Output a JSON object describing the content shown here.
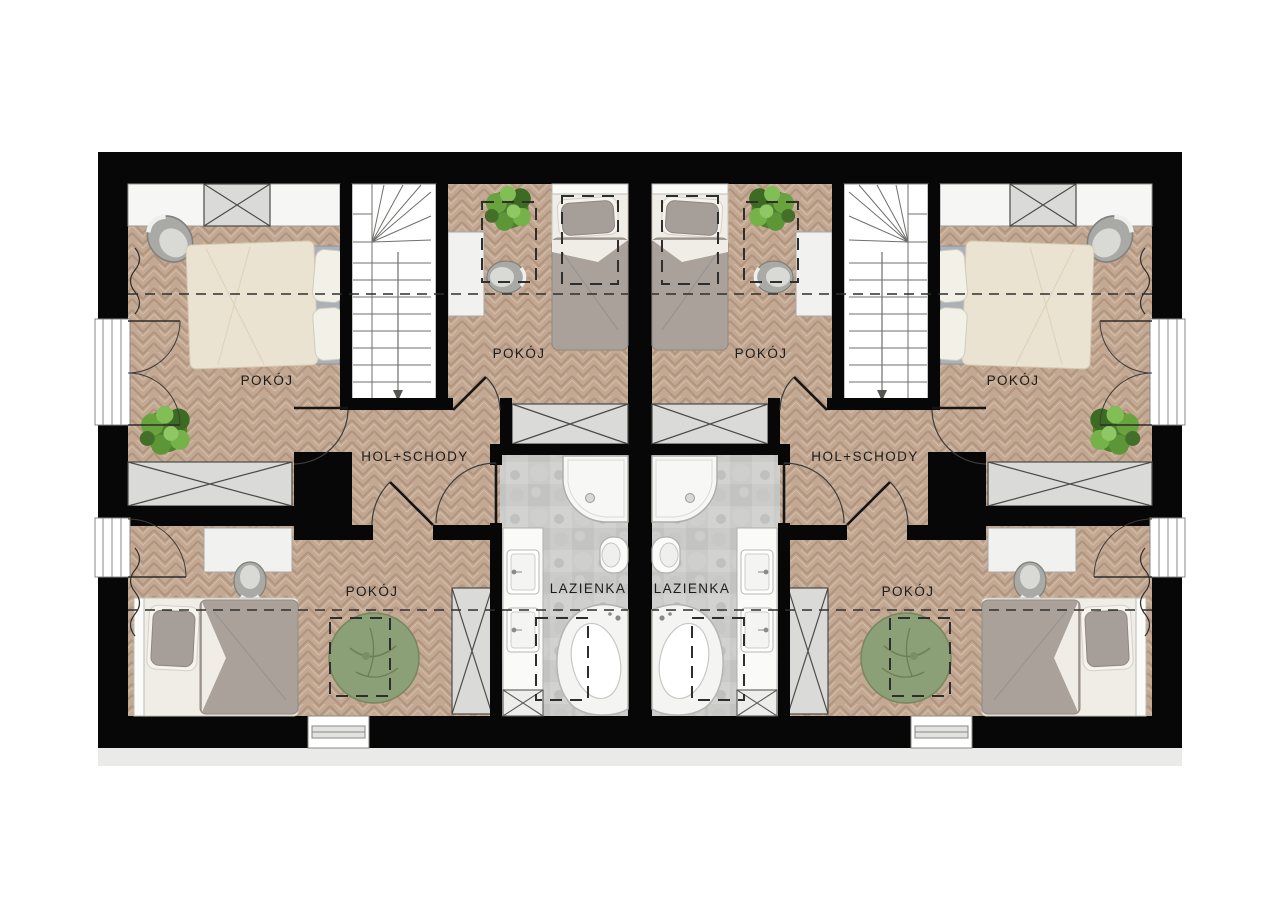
{
  "page": {
    "type": "architectural-floor-plan",
    "description": "Upper-floor plan of a mirrored twin (semi-detached) house",
    "background": "#ffffff"
  },
  "colors": {
    "wall": "#070707",
    "wood_floor": "#c3a993",
    "wood_groove": "#b2957e",
    "wood_highlight": "#d7c1ac",
    "bath_tile": "#cbcbc9",
    "white_fixture": "#f6f6f5",
    "cabinet_gray": "#dadad8",
    "bed_gray": "#a9a19a",
    "bed_cream": "#ebe3d2",
    "mattress_gray": "#aab1b8",
    "beanbag_green": "#8ca078",
    "plant_green": "#5d9636",
    "line": "#3c3c3c",
    "label_text": "#1c1c1c"
  },
  "floorplan": {
    "units": [
      {
        "side": "left",
        "rooms": [
          {
            "id": "bedroom-large",
            "label": "POKÓJ"
          },
          {
            "id": "bedroom-small",
            "label": "POKÓJ"
          },
          {
            "id": "bedroom-bottom",
            "label": "POKÓJ"
          },
          {
            "id": "hall-stairs",
            "label": "HOL+SCHODY"
          },
          {
            "id": "bathroom",
            "label": "LAZIENKA"
          }
        ]
      },
      {
        "side": "right",
        "rooms": [
          {
            "id": "bedroom-large",
            "label": "POKÓJ"
          },
          {
            "id": "bedroom-small",
            "label": "POKÓJ"
          },
          {
            "id": "bedroom-bottom",
            "label": "POKÓJ"
          },
          {
            "id": "hall-stairs",
            "label": "HOL+SCHODY"
          },
          {
            "id": "bathroom",
            "label": "LAZIENKA"
          }
        ]
      }
    ],
    "symbols": [
      "double-bed",
      "single-bed",
      "wardrobe-crossed",
      "built-in-closet",
      "stairs-winder",
      "desk",
      "desk-chair",
      "armchair",
      "bean-bag",
      "potted-plant",
      "shower-tray",
      "wall-hung-toilet",
      "vanity-with-sinks",
      "washer",
      "corner-bathtub",
      "balcony-door-window",
      "bottom-window",
      "knee-wall-dashed-line",
      "roof-window-dashed"
    ]
  }
}
